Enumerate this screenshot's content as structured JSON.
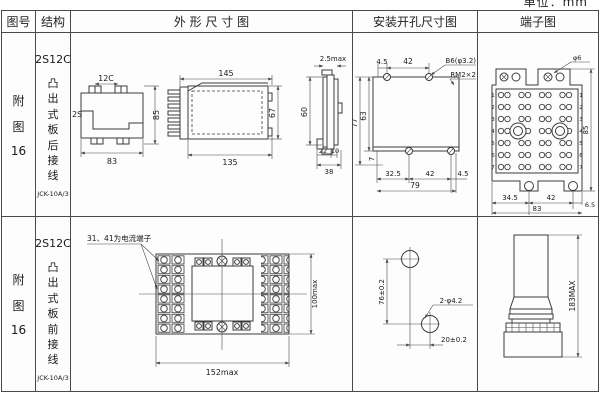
{
  "page": {
    "unit_note": "单位：mm"
  },
  "headers": {
    "fig_no": "图号",
    "structure": "结构",
    "outline": "外 形 尺 寸 图",
    "mounting": "安装开孔尺寸图",
    "terminal": "端子图"
  },
  "row1": {
    "fig": {
      "l1": "附",
      "l2": "图",
      "l3": "16"
    },
    "structure": {
      "model": "2S12C",
      "type": "凸出式板后接线",
      "code": "JCK-10A/3"
    },
    "outline": {
      "front": {
        "top_label": "12C",
        "left_label": "2S",
        "height": "85",
        "width": "83"
      },
      "side": {
        "top": "145",
        "bottom": "135",
        "height": "67"
      },
      "end": {
        "top": "2.5max",
        "height": "60",
        "w1": "22",
        "w2": "10",
        "total": "38"
      }
    },
    "mounting": {
      "top1": "4.5",
      "top2": "42",
      "hole_label": "B6(φ3.2)",
      "thread_label": "RM2×2",
      "left_outer": "77",
      "left_inner": "63",
      "bottom_offset": "7",
      "b1": "32.5",
      "b2": "42",
      "b3": "4.5",
      "total": "79"
    },
    "terminal": {
      "top_label": "φ6",
      "b1": "34.5",
      "b2": "42",
      "b3": "6.5",
      "total": "83",
      "height": "85",
      "rows_left": [
        "1",
        "2",
        "3",
        "4",
        "5",
        "6",
        "7"
      ],
      "rows_right": [
        "1",
        "2",
        "3",
        "4",
        "5",
        "6",
        "7"
      ]
    }
  },
  "row2": {
    "fig": {
      "l1": "附",
      "l2": "图",
      "l3": "16"
    },
    "structure": {
      "model": "2S12C",
      "type": "凸出式板前接线",
      "code": "JCK-10A/3"
    },
    "outline": {
      "note": "31、41为电流端子",
      "width": "152max",
      "height": "100max"
    },
    "mounting": {
      "v": "76±0.2",
      "hole_label": "2-φ4.2",
      "h": "20±0.2"
    },
    "terminal": {
      "height": "183MAX"
    }
  }
}
